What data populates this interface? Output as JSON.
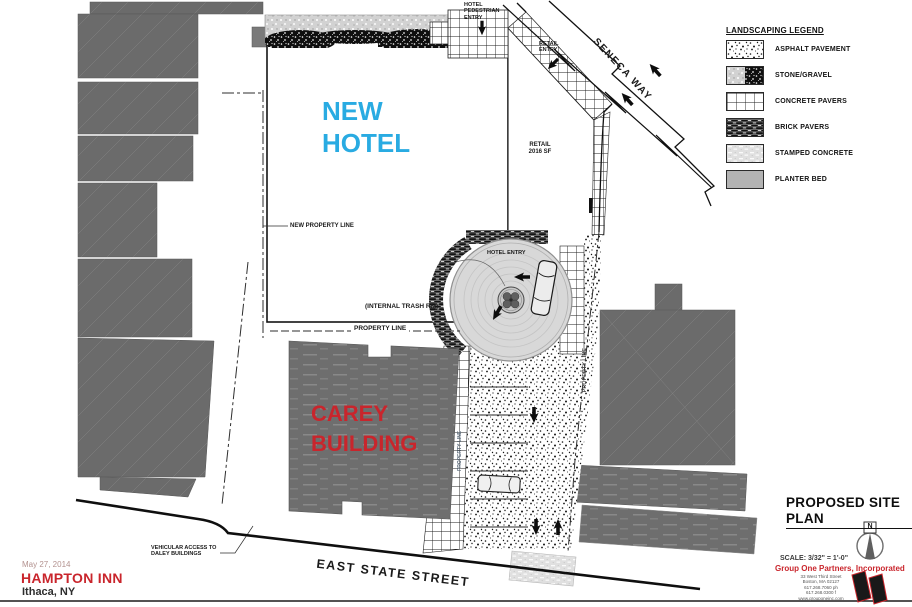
{
  "colors": {
    "hotel_blue": "#29abe2",
    "brand_red": "#c9252c",
    "building_gray": "#6b6b6b"
  },
  "legend": {
    "title": "LANDSCAPING LEGEND",
    "items": [
      {
        "label": "ASPHALT PAVEMENT"
      },
      {
        "label": "STONE/GRAVEL"
      },
      {
        "label": "CONCRETE PAVERS"
      },
      {
        "label": "BRICK PAVERS"
      },
      {
        "label": "STAMPED CONCRETE"
      },
      {
        "label": "PLANTER BED"
      }
    ]
  },
  "streets": {
    "seneca_way": "SENECA WAY",
    "east_state_street": "EAST STATE STREET"
  },
  "buildings": {
    "new_hotel": "NEW\nHOTEL",
    "carey": "CAREY\nBUILDING",
    "retail": "RETAIL\n2016 SF"
  },
  "labels": {
    "hotel_pedestrian_entry": "HOTEL\nPEDESTRIAN\nENTRY",
    "retail_entry": "RETAIL\nENTRY",
    "hotel_entry": "HOTEL ENTRY",
    "new_property_line": "NEW PROPERTY LINE",
    "property_line_bottom": "PROPERTY LINE",
    "property_line_east": "PROPERTY LINE",
    "property_line_walk": "PROPERTY LINE",
    "internal_trash_rm": "(INTERNAL TRASH RM)",
    "vehicular_access": "VEHICULAR ACCESS TO\nDALEY BUILDINGS"
  },
  "title_block": {
    "date": "May 27, 2014",
    "project": "HAMPTON INN",
    "location": "Ithaca, NY",
    "sheet_title": "PROPOSED SITE PLAN",
    "scale": "SCALE: 3/32\" = 1'-0\"",
    "firm": "Group One Partners, Incorporated",
    "address": "33 West Third Street\nBoston, MA 02127\n617.268.7060 ph\n617.268.0300 f\nwww.grouponeinc.com",
    "north_label": "N"
  }
}
